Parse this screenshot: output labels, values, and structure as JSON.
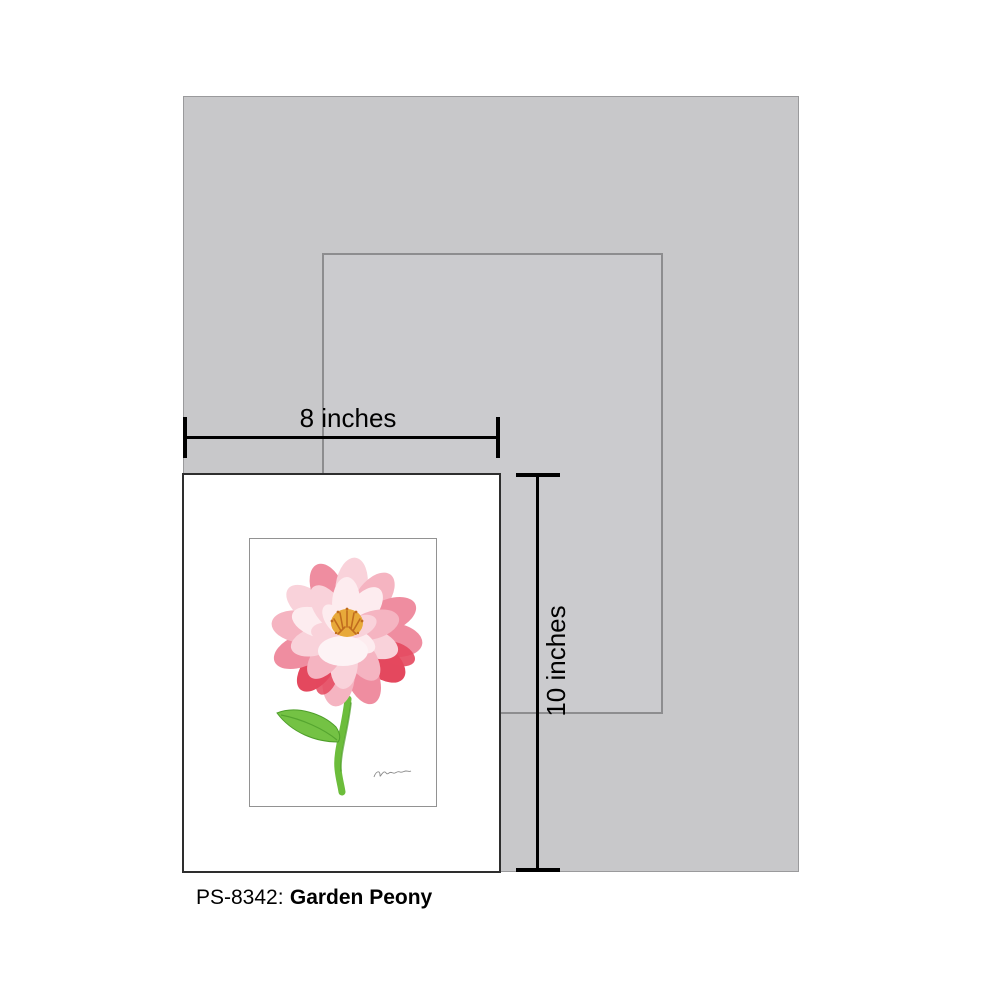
{
  "size_guide": {
    "width_label": "8 inches",
    "height_label": "10 inches"
  },
  "caption": {
    "sku": "PS-8342:",
    "title": "Garden Peony"
  },
  "colors": {
    "page_bg": "#ffffff",
    "mat_fill": "#c8c8ca",
    "mat_border": "#9a9a9c",
    "outline_fill": "#cbcbce",
    "outline_border": "#8d8d8f",
    "print_fill": "#ffffff",
    "print_border": "#2e2e2e",
    "frame_border": "#929292",
    "dim_color": "#000000",
    "text_color": "#000000",
    "petal_deep": "#e4485e",
    "petal_mid": "#ef8da0",
    "petal_soft": "#f5b4c1",
    "petal_light": "#f9d2da",
    "petal_pale": "#fdecef",
    "stamen_yellow": "#e8a93a",
    "stamen_orange": "#c06c1e",
    "stem_green": "#6cbd3b",
    "leaf_green": "#74c244",
    "leaf_dark": "#4e9e2a",
    "signature_gray": "#8a8a8a"
  }
}
